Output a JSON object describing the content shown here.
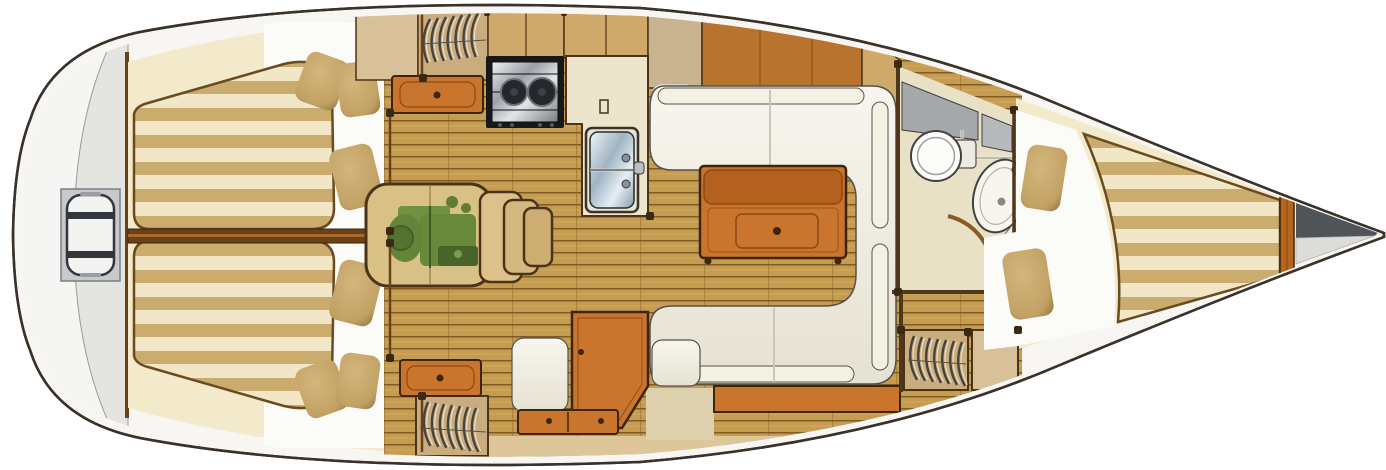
{
  "diagram": {
    "kind": "sailboat-interior-floorplan-top-view",
    "components": [
      "stern-swim-ladder",
      "aft-cabin-port-berth",
      "aft-cabin-starboard-berth",
      "berth-pillows",
      "engine-compartment",
      "companionway-steps",
      "hanging-locker-port",
      "hanging-locker-starboard",
      "hanging-locker-bow",
      "drawer-unit-port",
      "drawer-unit-starboard",
      "galley-stove",
      "galley-counter",
      "galley-sink",
      "dinette-settee",
      "salon-table",
      "nav-seat",
      "chart-table",
      "chart-drawers",
      "head-toilet",
      "head-sink",
      "head-door",
      "v-berth",
      "bow-anchor-locker",
      "cabin-sole-planks"
    ]
  },
  "colors": {
    "hull_outline": "#39312a",
    "deck_white": "#f7f6f3",
    "stern_inner": "#e4e4e1",
    "ladder_frame": "#c6cacc",
    "ladder_bar": "#33373b",
    "cream_band": "#f3e9cb",
    "stripe_cream": "#f1e7c6",
    "stripe_tan": "#c9ac6e",
    "mattress_edge": "#6b4a20",
    "pillow": "#c2a164",
    "pillow_dark": "#8f7140",
    "bulkhead": "#6b4218",
    "wall_dark": "#50361a",
    "post": "#3a2a14",
    "wood_floor": "#c69c50",
    "plank_line": "#7d5c26",
    "plank_hi": "#dfbe78",
    "cabinet_tan": "#cfa96a",
    "locker_tan": "#c9ad7f",
    "panel_light": "#d8c098",
    "panel_tan": "#c9b491",
    "panel_orange": "#b8742f",
    "orange_wood": "#c9752e",
    "orange_dark": "#b5611e",
    "settee_hi": "#f7f5ee",
    "settee_lo": "#e6e2d2",
    "counter_cream": "#ece4cb",
    "head_floor": "#e9e1c6",
    "gray_counter": "#a6a9ac",
    "gray_counter2": "#b7babc",
    "engine_bg": "#d9c185",
    "engine_green": "#55802e",
    "engine_green_dark": "#3f6622",
    "step_wood": "#dcc18a",
    "metal_hi": "#f0f2f4",
    "metal_lo": "#787e84",
    "sink_hi": "#eef5fa",
    "sink_lo": "#869cac",
    "anchor_dark": "#4e5458",
    "anchor_light": "#dcdcda",
    "white_zone": "#fbfbf8",
    "strip_light": "#dcc69a",
    "beige_patch": "#ddd0ac"
  }
}
